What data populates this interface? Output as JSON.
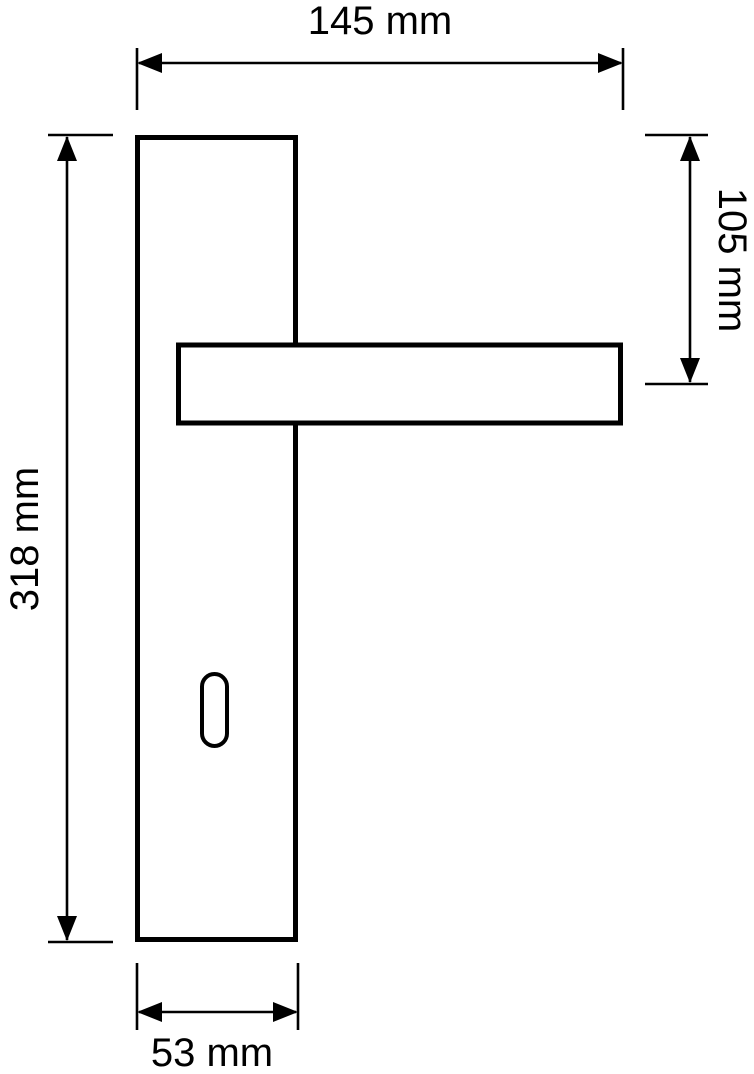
{
  "diagram": {
    "kind": "technical-dimension-drawing",
    "subject": "door handle with long backplate and keyhole",
    "background_color": "#ffffff",
    "line_color": "#000000",
    "unit": "mm",
    "dimensions": {
      "overall_width": {
        "label": "145 mm",
        "value": 145,
        "unit": "mm"
      },
      "handle_axis_offset": {
        "label": "105 mm",
        "value": 105,
        "unit": "mm"
      },
      "plate_height": {
        "label": "318 mm",
        "value": 318,
        "unit": "mm"
      },
      "plate_width": {
        "label": "53 mm",
        "value": 53,
        "unit": "mm"
      }
    }
  }
}
